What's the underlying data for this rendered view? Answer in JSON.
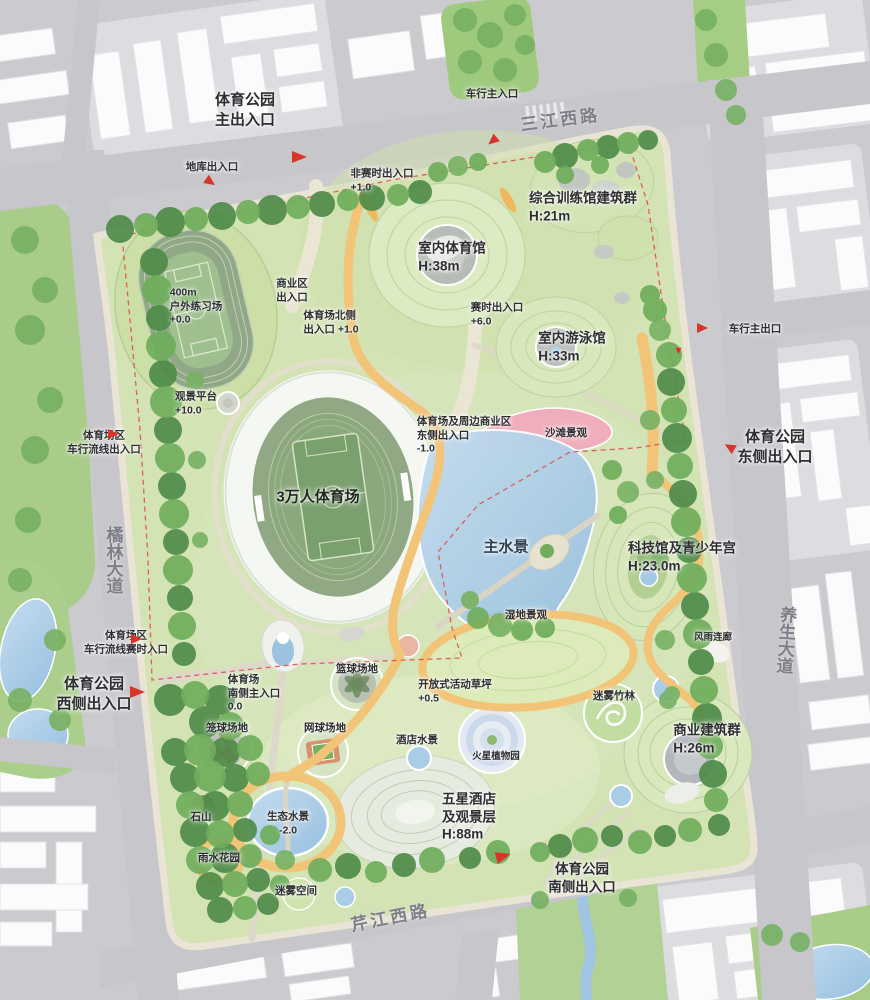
{
  "roads": {
    "north": "三江西路",
    "west": "橘林大道",
    "east": "养生大道",
    "south": "芹江西路"
  },
  "labels": [
    {
      "id": "park-main-entrance",
      "text": "体育公园\n主出入口"
    },
    {
      "id": "veh-main-entrance",
      "text": "车行主入口"
    },
    {
      "id": "garage-entrance",
      "text": "地库出入口"
    },
    {
      "id": "offseason-entrance",
      "text": "非赛时出入口\n+1.0"
    },
    {
      "id": "training-complex",
      "text": "综合训练馆建筑群\nH:21m"
    },
    {
      "id": "indoor-gym",
      "text": "室内体育馆\nH:38m"
    },
    {
      "id": "games-entrance",
      "text": "赛时出入口\n+6.0"
    },
    {
      "id": "natatorium",
      "text": "室内游泳馆\nH:33m"
    },
    {
      "id": "outdoor-track",
      "text": "400m\n户外练习场\n+0.0"
    },
    {
      "id": "commercial-entrance",
      "text": "商业区\n出入口"
    },
    {
      "id": "stadium-north-entrance",
      "text": "体育场北侧\n出入口 +1.0"
    },
    {
      "id": "viewing-platform",
      "text": "观景平台\n+10.0"
    },
    {
      "id": "stadium-veh-entrance",
      "text": "体育场区\n车行流线出入口"
    },
    {
      "id": "veh-main-exit",
      "text": "车行主出口"
    },
    {
      "id": "park-east-entrance",
      "text": "体育公园\n东侧出入口"
    },
    {
      "id": "stadium-biz-east-entrance",
      "text": "体育场及周边商业区\n东侧出入口\n-1.0"
    },
    {
      "id": "beach",
      "text": "沙滩景观"
    },
    {
      "id": "stadium",
      "text": "3万人体育场"
    },
    {
      "id": "main-water",
      "text": "主水景"
    },
    {
      "id": "wetland",
      "text": "湿地景观"
    },
    {
      "id": "science-youth",
      "text": "科技馆及青少年宫\nH:23.0m"
    },
    {
      "id": "rain-corridor",
      "text": "风雨连廊"
    },
    {
      "id": "stadium-veh-games-entrance",
      "text": "体育场区\n车行流线赛时入口"
    },
    {
      "id": "park-west-entrance",
      "text": "体育公园\n西侧出入口"
    },
    {
      "id": "stadium-south-entrance",
      "text": "体育场\n南侧主入口\n0.0"
    },
    {
      "id": "basketball-court",
      "text": "篮球场地"
    },
    {
      "id": "open-lawn",
      "text": "开放式活动草坪\n+0.5"
    },
    {
      "id": "cage-court",
      "text": "笼球场地"
    },
    {
      "id": "tennis-court",
      "text": "网球场地"
    },
    {
      "id": "hotel-water",
      "text": "酒店水景"
    },
    {
      "id": "mist-bamboo",
      "text": "迷雾竹林"
    },
    {
      "id": "commercial-cluster",
      "text": "商业建筑群\nH:26m"
    },
    {
      "id": "mars-garden",
      "text": "火星植物园"
    },
    {
      "id": "five-star-hotel",
      "text": "五星酒店\n及观景层\nH:88m"
    },
    {
      "id": "stone-hill",
      "text": "石山"
    },
    {
      "id": "eco-water",
      "text": "生态水景\n-2.0"
    },
    {
      "id": "rain-garden",
      "text": "雨水花园"
    },
    {
      "id": "mist-space",
      "text": "迷雾空间"
    },
    {
      "id": "park-south-entrance",
      "text": "体育公园\n南侧出入口"
    }
  ],
  "colors": {
    "park_green": "#d3e3b3",
    "tree_green": "#4f8c49",
    "water_blue": "#a9cde6",
    "beach_pink": "#f0aebc",
    "path_yellow": "#f1c478",
    "road_gray": "#c7c7cb",
    "boundary_red": "#e05050",
    "building_white": "#fbfbfc"
  }
}
